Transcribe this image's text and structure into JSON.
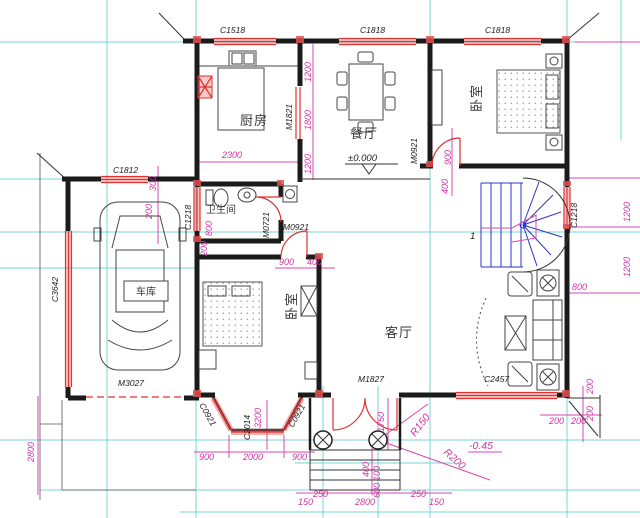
{
  "colors": {
    "wall": "#1b1b1b",
    "window_red": "#e03030",
    "dimension_magenta": "#d94ab0",
    "grid_cyan": "#74d6d6",
    "stair_blue": "#2b35c8"
  },
  "rooms": {
    "kitchen": "厨房",
    "dining": "餐厅",
    "bedroom_top": "卧室",
    "bedroom_bottom": "卧室",
    "living": "客厅",
    "bathroom": "卫生间",
    "garage": "车库"
  },
  "windows": {
    "c1518": "C1518",
    "c1818_dining": "C1818",
    "c1818_bedroom": "C1818",
    "c1812": "C1812",
    "c3642": "C3642",
    "c1218_garage": "C1218",
    "c1218_stair": "C1218",
    "c2457": "C2457",
    "c0921_left": "C0921",
    "c0921_right": "C0921",
    "c2014": "C2014"
  },
  "doors": {
    "m1821": "M1821",
    "m0921_bedroom": "M0921",
    "m0921_hall": "M0921",
    "m0721": "M0721",
    "m1827": "M1827",
    "m3027": "M3027"
  },
  "levels": {
    "ground": "±0.000",
    "porch": "-0.45"
  },
  "radii": {
    "r150": "R150",
    "r200": "R200"
  },
  "stair": {
    "flight_number": "1"
  },
  "dims": {
    "kitchen_2300": "2300",
    "dining_1200": "1200",
    "dining_1800": "1800",
    "dining_1200b": "1200",
    "bed_900": "900",
    "bed_400": "400",
    "right_1200a": "1200",
    "right_1200b": "1200",
    "stair_800": "800",
    "garage_300": "300",
    "garage_200": "200",
    "bath_800": "800",
    "bath_200": "200",
    "hall_900": "900",
    "hall_400": "400",
    "left_2800": "2800",
    "bay_900l": "900",
    "bay_2000": "2000",
    "bay_900r": "900",
    "bay_3200": "3200",
    "porch_1750": "1750",
    "step_400": "400",
    "step_100": "100",
    "step_600": "600",
    "bottom_150l": "150",
    "bottom_250l": "250",
    "bottom_2800": "2800",
    "bottom_250r": "250",
    "bottom_150r": "150",
    "corner_200a": "200",
    "corner_200b": "200",
    "corner_200c": "200",
    "corner_200d": "200"
  }
}
